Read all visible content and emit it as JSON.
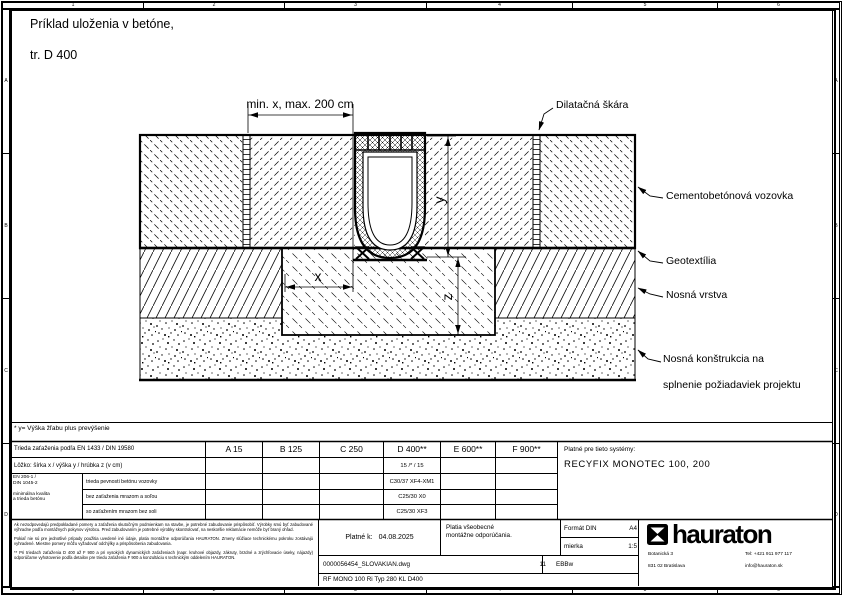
{
  "page": {
    "title1": "Príklad uloženia v betóne,",
    "title2": "tr. D 400"
  },
  "ruler": {
    "cols": [
      "1",
      "2",
      "3",
      "4",
      "5",
      "6"
    ],
    "rows": [
      "A",
      "B",
      "C",
      "D"
    ]
  },
  "drawing": {
    "dim_top": "min. x, max. 200 cm",
    "dim_x": "x",
    "dim_y": "y",
    "dim_z": "z",
    "labels": {
      "dilatation": "Dilatačná škára",
      "pavement": "Cementobetónová vozovka",
      "geotextile": "Geotextília",
      "base_layer": "Nosná vrstva",
      "substructure1": "Nosná konštrukcia na",
      "substructure2": "splnenie požiadaviek projektu"
    }
  },
  "footnote": {
    "text": "* y= Výška žľabu plus prevýšenie"
  },
  "table": {
    "load_class_label": "Trieda zaťaženia podľa EN 1433 / DIN 19580",
    "classes": [
      "A 15",
      "B 125",
      "C 250",
      "D 400**",
      "E 600**",
      "F 900**"
    ],
    "bedding_label": "Lôžko: šírka x / výška y / hrúbka z (v cm)",
    "bedding_d400": "15 /* / 15",
    "std1": "EN 206-1 /",
    "std2": "DIN 1045-2",
    "std3": "minimálna kvalita",
    "std4": "a trieda betónu",
    "rows": [
      {
        "label": "trieda pevnosti betónu vozovky",
        "d400": "C30/37 XF4-XM1"
      },
      {
        "label": "bez zaťaženia mrazom a soľou",
        "d400": "C25/30 X0"
      },
      {
        "label": "so zaťažením mrazom bez soli",
        "d400": "C25/30 XF3"
      }
    ],
    "systems_label": "Platné pre tieto systémy:",
    "systems_value": "RECYFIX MONOTEC 100, 200"
  },
  "titleblock": {
    "fineprint1": "Ak nezodpovedajú predpokladané pomery a zaťaženia skutočným podmienkam na stavbe, je potrebné zabudovanie prispôsobiť. Výrobky smú byť zabudované výhradne podľa montážnych pokynov výrobcu. Pred zabudovaním je potrebné výrobky skontrolovať, na neskoršie reklamácie nemôže byť braný ohľad.",
    "fineprint2": "Pokiaľ nie sú pre jednotlivé prípady použitia uvedené iné údaje, platia montážne odporúčania HAURATON. Zmeny slúžiace technickému pokroku zostávajú vyhradené. Miestne pomery môžu vyžadovať odchýlky a prispôsobenia zabudovania.",
    "fineprint3": "** Pri triedach zaťaženia D 400 až F 900 a pri vysokých dynamických zaťaženiach (napr. kruhové objazdy, zákruty, brzdné a zrýchľovacie úseky, nájazdy) odporúčame vyhotovenie podľa detailov pre triedu zaťaženia F 900 a konzultáciu s technickým oddelením HAURATON.",
    "valid_label": "Platné k:",
    "valid_date": "04.08.2025",
    "note1": "Platia všeobecné",
    "note2": "montážne odporúčania.",
    "format_label": "Formát DIN",
    "format_value": "A4",
    "scale_label": "mierka",
    "scale_value": "1:5",
    "file_name": "0000056454_SLOVAKIAN.dwg",
    "sheet_no": "11",
    "author": "EBBw",
    "type_row": "RF MONO 100 Ri Typ 280 KL D400",
    "brand": "hauraton",
    "address1": "Botanická 3",
    "address2": "831 02 Bratislava",
    "contact1": "Tel: +421 911 977 117",
    "contact2": "info@hauraton.sk"
  }
}
